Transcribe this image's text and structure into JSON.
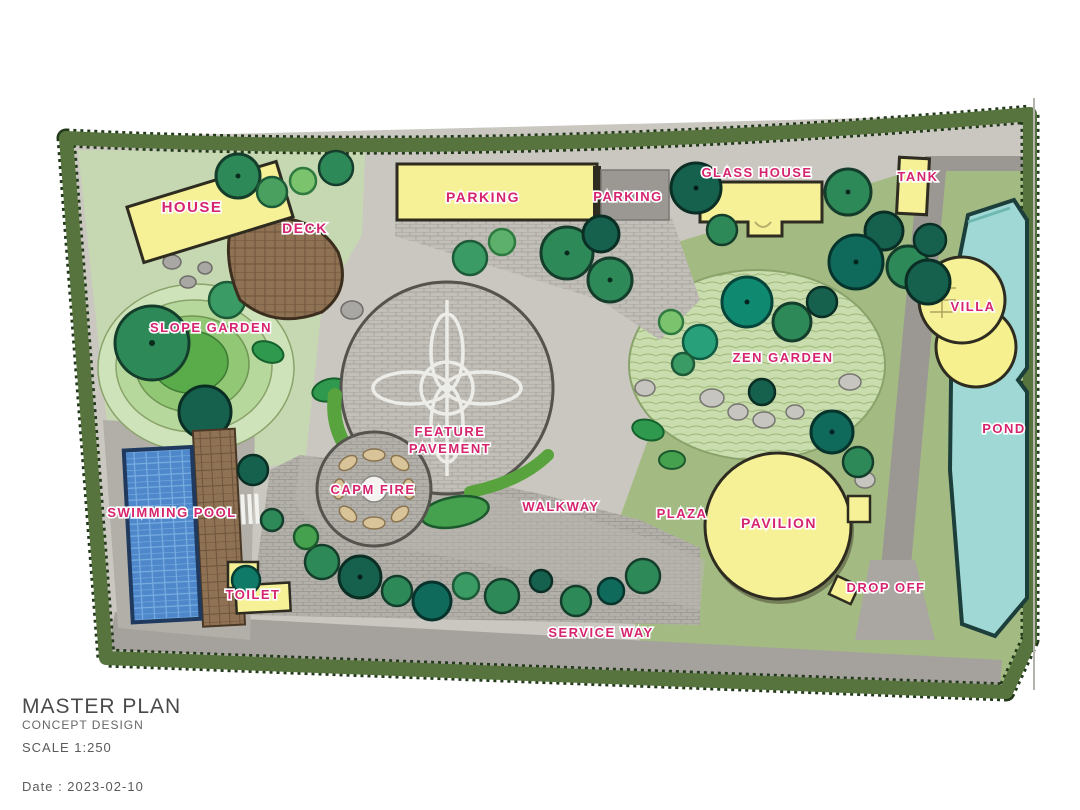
{
  "plan": {
    "labels": {
      "house": "HOUSE",
      "deck": "DECK",
      "parking_main": "PARKING",
      "parking_small": "PARKING",
      "glass_house": "GLASS HOUSE",
      "tank": "TANK",
      "villa": "VILLA",
      "slope_garden": "SLOPE GARDEN",
      "zen_garden": "ZEN GARDEN",
      "feature_pavement_line1": "FEATURE",
      "feature_pavement_line2": "PAVEMENT",
      "camp_fire": "CAPM FIRE",
      "swimming_pool": "SWIMMING POOL",
      "toilet": "TOILET",
      "walkway": "WALKWAY",
      "plaza": "PLAZA",
      "pavilion": "PAVILION",
      "drop_off": "DROP OFF",
      "service_way": "SERVICE WAY",
      "pond": "POND"
    },
    "colors": {
      "label_text": "#d6246e",
      "building_fill": "#f6f096",
      "pond_fill": "#9fd8d4",
      "pool_fill": "#4e88cb",
      "hedge_fill": "#57743f",
      "hedge_edge": "#22391a",
      "lawn_light": "#c6d8b2",
      "lawn_sage": "#a3bb82",
      "pavement_gray": "#b7b4ae",
      "deck_brown": "#8f7254",
      "tree_dark": "#16604e",
      "tree_mid": "#2d8a58",
      "tree_light": "#7cc36e"
    }
  },
  "title_block": {
    "title": "MASTER PLAN",
    "subtitle": "CONCEPT DESIGN",
    "scale": "SCALE  1:250",
    "date": "Date : 2023-02-10"
  }
}
